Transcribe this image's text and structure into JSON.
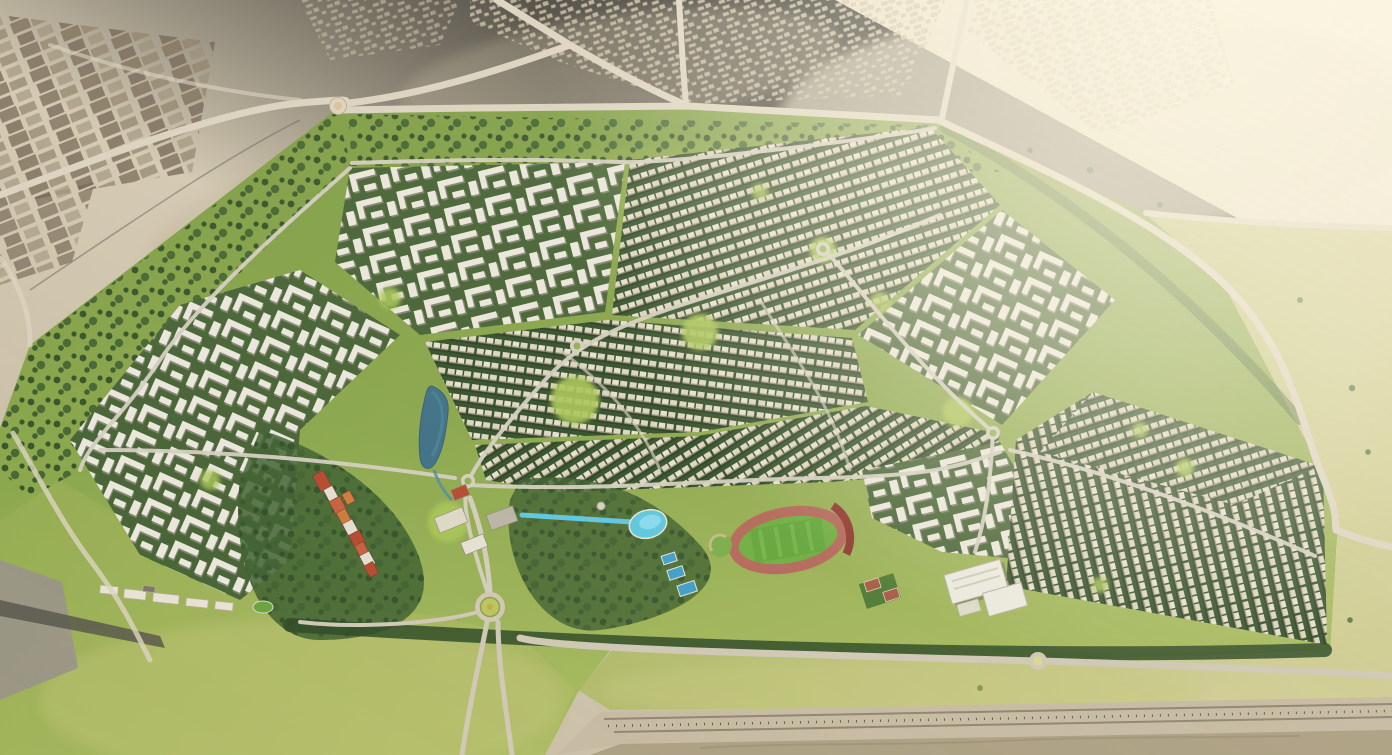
{
  "scene": {
    "kind": "aerial-3d-masterplan-rendering",
    "features": [
      "desert-surroundings",
      "existing-city-fabric",
      "farm-plots",
      "desert-roads",
      "desert-roundabout",
      "community-boundary",
      "perimeter-green-buffer",
      "northwest-apartments",
      "north-townhouse-rows",
      "northeast-apartments",
      "west-apartment-blocks",
      "central-townhouse-rows",
      "east-apartments",
      "villa-grid-district",
      "pocket-parks",
      "central-lake",
      "water-canal",
      "lagoon-pool",
      "swimming-pools",
      "town-center-strip",
      "commercial-halls",
      "observation-tower",
      "running-track-stadium",
      "practice-field",
      "tennis-courts",
      "school-campus",
      "clubhouse-row",
      "sports-pitch",
      "internal-roads",
      "roundabouts",
      "entrance-roundabout",
      "south-meadow",
      "access-road",
      "highway-corridor",
      "gravel-strip",
      "sun-glare"
    ]
  },
  "palette": {
    "desert_light": "#e8dfc9",
    "desert_mid": "#cfc5ae",
    "desert_shadow": "#b6aa91",
    "plots_dark": "#6f6250",
    "plots_mid": "#7c6e59",
    "plots_light": "#95886f",
    "city_block": "#c6bba4",
    "city_edge": "#9a8e76",
    "road": "#dbd3c0",
    "road_edge": "#b0a58c",
    "asphalt": "#6e6a60",
    "grass_top": "#7d9c44",
    "grass_mid": "#8aa74c",
    "meadow": "#a7ba5e",
    "meadow_light": "#b9c274",
    "grass_east": "#c3c585",
    "tree_dark": "#2e4a26",
    "tree_mid": "#3e6030",
    "block_green": "#33502a",
    "house_roof": "#ddd5bf",
    "house_light": "#e7e1cd",
    "eave_shadow": "#8d866f",
    "apt_bg": "#466335",
    "apt_roof": "#eae7dc",
    "apt_shadow": "#8f8b7d",
    "park_green": "#a9c556",
    "lake": "#3e7086",
    "lake_light": "#4f8ba0",
    "pool": "#5ec7de",
    "pool_light": "#8adcee",
    "pool_deep": "#3f9fc9",
    "deck": "#e8e2d2",
    "red_roof": "#b5492f",
    "red_roof_light": "#c75f3d",
    "orange_roof": "#cd7a3a",
    "hall_roof": "#ded8c8",
    "grey_roof": "#b9b4a4",
    "track": "#b4685a",
    "bleachers": "#8e382f",
    "pitch": "#64a63c",
    "pitch_light": "#79b94c",
    "court": "#a85a44",
    "school_roof": "#eceadf",
    "school_edge": "#b8b2a2",
    "highway": "#c6bba2",
    "gravel": "#aca083",
    "glare": "#fdf7e3",
    "embankment": "#9a948a",
    "embankment_dark": "#55524a"
  }
}
